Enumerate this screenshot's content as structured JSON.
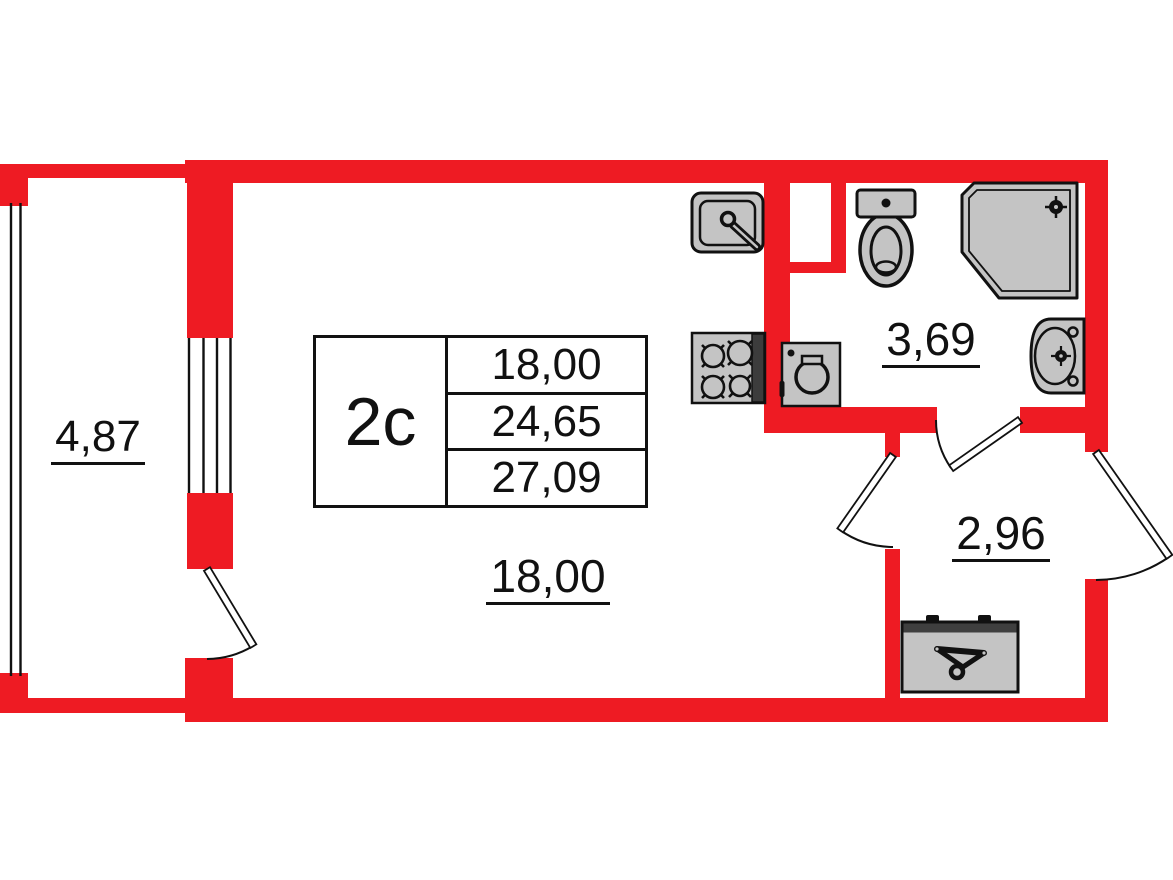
{
  "unit": {
    "code": "2с",
    "area_rows": [
      "18,00",
      "24,65",
      "27,09"
    ]
  },
  "rooms": {
    "balcony": "4,87",
    "living_room": "18,00",
    "bathroom": "3,69",
    "hallway": "2,96"
  },
  "colors": {
    "wall_red": "#ee1b23",
    "fixture_gray": "#c4c4c4",
    "line_black": "#111111"
  },
  "fixtures": [
    "kitchen-sink",
    "cooktop",
    "washing-machine",
    "toilet",
    "shower-cabin",
    "washbasin",
    "wardrobe"
  ]
}
